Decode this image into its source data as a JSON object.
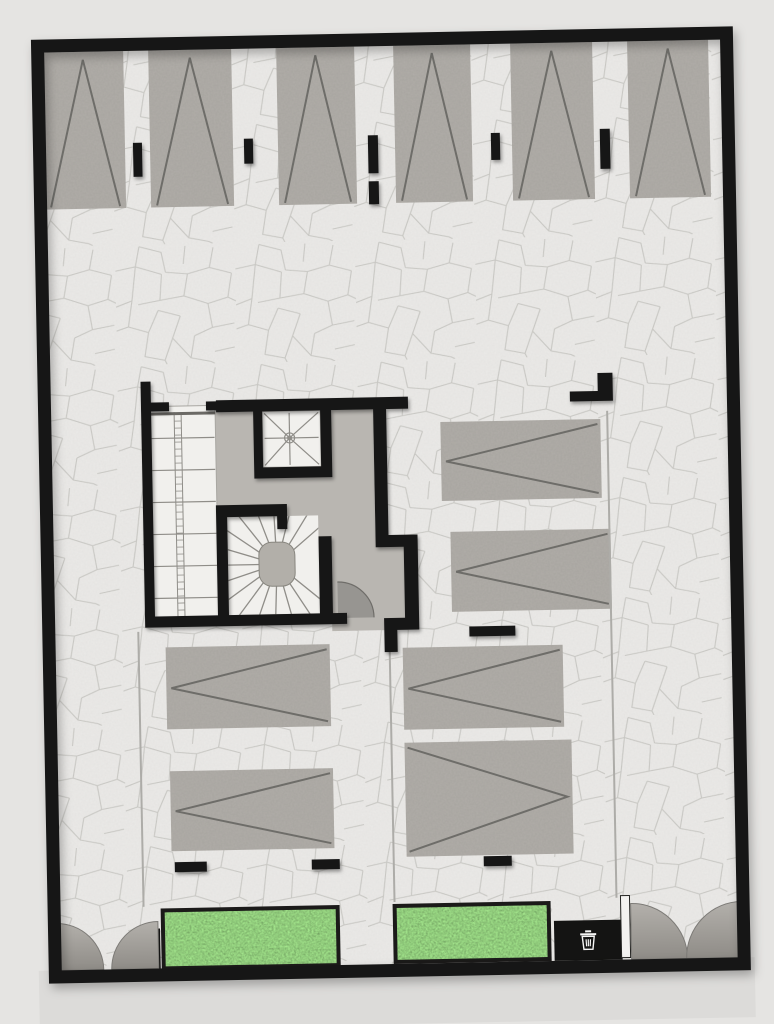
{
  "scene": {
    "name": "parking-level-floor-plan",
    "kind": "top-down architectural rendering of a parking / ground level with stair core, parking stalls, planters, trash point and entry gates",
    "parking_stall_count": 12,
    "planter_count": 2,
    "stair_count": 3,
    "gate_count": 2,
    "trash_point_count": 1
  },
  "palette": {
    "background": "#e5e4e2",
    "street": "#dcdbd9",
    "pavement": "#efeeec",
    "cracks": "#c9c9c5",
    "wall": "#141413",
    "concrete": "#b6b3ae",
    "marking": "#6e6d69",
    "core_floor": "#b9b6b1",
    "stair_floor": "#f1f0ed",
    "stair_line": "#8f8d88",
    "newel": "#b2afa9",
    "door_leaf": "#8f8d89",
    "door_edge": "#6f6d69",
    "lane_line": "#adaca8",
    "gate_top": "#b3b0ab",
    "gate_bottom": "#8f8c87",
    "gate_edge": "#7d7b77",
    "grass_base": "#5f9f50",
    "planter_frame": "#1b1a19",
    "slot_fill": "#f3f2f0",
    "bin_icon": "#f5f5f4"
  },
  "plan": {
    "rotation_deg": -1.1,
    "rotation_cx": 390,
    "rotation_cy": 510,
    "street_apron": {
      "x": 30,
      "y": 964,
      "w": 716,
      "h": 60
    },
    "pavement": {
      "x": 52,
      "y": 45,
      "w": 678,
      "h": 920
    },
    "outline": {
      "x": 46.5,
      "y": 39.5,
      "w": 689,
      "h": 931,
      "stroke_w": 13
    },
    "stalls": [
      {
        "x": 51,
        "y": 46,
        "w": 81,
        "h": 157,
        "marking": "apex-up"
      },
      {
        "x": 157,
        "y": 46,
        "w": 83,
        "h": 157,
        "marking": "apex-up"
      },
      {
        "x": 285,
        "y": 46,
        "w": 78,
        "h": 157,
        "marking": "apex-up"
      },
      {
        "x": 402,
        "y": 46,
        "w": 77,
        "h": 157,
        "marking": "apex-up"
      },
      {
        "x": 519,
        "y": 46,
        "w": 82,
        "h": 157,
        "marking": "apex-up"
      },
      {
        "x": 636,
        "y": 46,
        "w": 81,
        "h": 157,
        "marking": "apex-up"
      },
      {
        "x": 442,
        "y": 423,
        "w": 160,
        "h": 79,
        "marking": "chevron-left"
      },
      {
        "x": 450,
        "y": 533,
        "w": 160,
        "h": 80,
        "marking": "chevron-left"
      },
      {
        "x": 163,
        "y": 643,
        "w": 164,
        "h": 82,
        "marking": "chevron-left"
      },
      {
        "x": 165,
        "y": 767,
        "w": 163,
        "h": 80,
        "marking": "chevron-left"
      },
      {
        "x": 400,
        "y": 648,
        "w": 160,
        "h": 82,
        "marking": "chevron-left"
      },
      {
        "x": 400,
        "y": 743,
        "w": 167,
        "h": 114,
        "marking": "chevron-right"
      }
    ],
    "wall_stubs": [
      {
        "x": 140,
        "y": 138,
        "w": 9,
        "h": 34
      },
      {
        "x": 251,
        "y": 136,
        "w": 9,
        "h": 25
      },
      {
        "x": 375,
        "y": 135,
        "w": 10,
        "h": 38
      },
      {
        "x": 375,
        "y": 181,
        "w": 10,
        "h": 23
      },
      {
        "x": 498,
        "y": 135,
        "w": 9,
        "h": 27
      },
      {
        "x": 607,
        "y": 133,
        "w": 10,
        "h": 40
      }
    ],
    "floor_bars": [
      {
        "x": 467,
        "y": 628,
        "w": 46,
        "h": 10
      },
      {
        "x": 168,
        "y": 858,
        "w": 32,
        "h": 10
      },
      {
        "x": 305,
        "y": 858,
        "w": 28,
        "h": 10
      },
      {
        "x": 477,
        "y": 858,
        "w": 28,
        "h": 10
      }
    ],
    "corner_marker": [
      {
        "x": 600,
        "y": 377,
        "w": 15,
        "h": 28
      },
      {
        "x": 572,
        "y": 395,
        "w": 43,
        "h": 10
      }
    ],
    "lane_lines": [
      {
        "x": 136,
        "y1": 627,
        "y2": 902
      },
      {
        "x": 387,
        "y1": 652,
        "y2": 902
      },
      {
        "x": 609,
        "y1": 415,
        "y2": 902
      }
    ],
    "core": {
      "floor_path": "M153 409 H375 V535 H417 V630 H330 V623 H153 Z",
      "walls": [
        {
          "x": 143,
          "y": 377,
          "w": 10,
          "h": 246
        },
        {
          "x": 218,
          "y": 397,
          "w": 192,
          "h": 12
        },
        {
          "x": 255,
          "y": 409,
          "w": 9,
          "h": 67
        },
        {
          "x": 255,
          "y": 465,
          "w": 78,
          "h": 11
        },
        {
          "x": 322,
          "y": 397,
          "w": 11,
          "h": 79
        },
        {
          "x": 375,
          "y": 409,
          "w": 13,
          "h": 138
        },
        {
          "x": 375,
          "y": 535,
          "w": 42,
          "h": 12
        },
        {
          "x": 403,
          "y": 535,
          "w": 14,
          "h": 95
        },
        {
          "x": 143,
          "y": 612,
          "w": 202,
          "h": 11
        },
        {
          "x": 216,
          "y": 502,
          "w": 71,
          "h": 12
        },
        {
          "x": 277,
          "y": 514,
          "w": 10,
          "h": 13
        },
        {
          "x": 216,
          "y": 502,
          "w": 11,
          "h": 121
        },
        {
          "x": 318,
          "y": 535,
          "w": 13,
          "h": 88
        },
        {
          "x": 382,
          "y": 618,
          "w": 35,
          "h": 12
        },
        {
          "x": 382,
          "y": 618,
          "w": 13,
          "h": 34
        },
        {
          "x": 153,
          "y": 398,
          "w": 18,
          "h": 9
        },
        {
          "x": 208,
          "y": 398,
          "w": 16,
          "h": 9
        }
      ],
      "straight_stair": {
        "x": 152,
        "y": 402,
        "w": 65,
        "h": 216,
        "tread_step": 32,
        "rail_x1": 176,
        "rail_x2": 183,
        "rung_step": 7
      },
      "square_stair": {
        "x": 264,
        "y": 409,
        "w": 58,
        "h": 56,
        "cx": 291,
        "cy": 436
      },
      "spiral_stair": {
        "room": {
          "x": 227,
          "y": 514,
          "w": 91,
          "h": 98
        },
        "newel": {
          "x": 258,
          "y": 540,
          "w": 36,
          "h": 44,
          "rx": 13
        },
        "cx": 276,
        "cy": 562,
        "r_inner": 17,
        "r_outer": 82,
        "a_start": 40,
        "a_end": 320,
        "a_step": 17.5
      },
      "door_swing": {
        "fill_path": "M336 617 L336 581 A36 36 0 0 1 372 617 Z",
        "arc_path": "M336 581 A36 36 0 0 1 372 617"
      }
    },
    "planters": [
      {
        "x": 153,
        "y": 904,
        "w": 179,
        "h": 62
      },
      {
        "x": 385,
        "y": 904,
        "w": 158,
        "h": 60
      }
    ],
    "trash": {
      "pad": {
        "x": 546,
        "y": 924,
        "w": 68,
        "h": 40
      },
      "icon_cx": 580,
      "icon_cy": 944
    },
    "gates": {
      "left_posts": [
        {
          "x": 42,
          "y": 924,
          "w": 5,
          "h": 40
        },
        {
          "x": 147,
          "y": 924,
          "w": 5,
          "h": 40
        }
      ],
      "left_leaves": [
        "M48 964 L48 917 A47 47 0 0 1 95 964 Z",
        "M150 964 L150 917 A47 47 0 0 0 103 964 Z"
      ],
      "right_slot": {
        "x": 613,
        "y": 900,
        "w": 9,
        "h": 62
      },
      "right_leaves": [
        "M623 964 L623 908 A56 56 0 0 1 679 964 Z",
        "M734 964 L734 908 A56 56 0 0 0 678 964 Z"
      ]
    }
  }
}
